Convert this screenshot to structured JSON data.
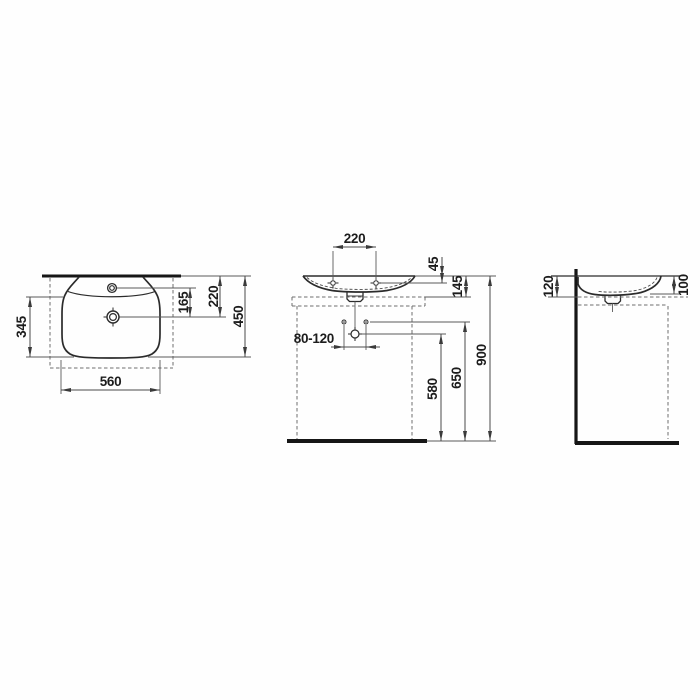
{
  "colors": {
    "outline": "#2b2b2b",
    "heavy_line": "#161616",
    "dim_line": "#5a5a5a",
    "dashed_line": "#6f6f6f",
    "background": "#fefefe"
  },
  "views": {
    "top": {
      "dims": {
        "width": "560",
        "bowl_depth": "345",
        "faucet_to_drain": "165",
        "back_to_drain": "220",
        "overall_depth": "450"
      }
    },
    "front": {
      "dims": {
        "tap_hole_spacing": "220",
        "rim_to_tap_deck": "45",
        "rim_to_underside": "145",
        "fixing_hole_spacing": "80-120",
        "floor_to_drain": "580",
        "floor_to_fixing_holes": "650",
        "floor_to_rim": "900"
      }
    },
    "side": {
      "dims": {
        "rim_to_underside": "120",
        "rim_to_bowl_bottom": "100"
      }
    }
  }
}
